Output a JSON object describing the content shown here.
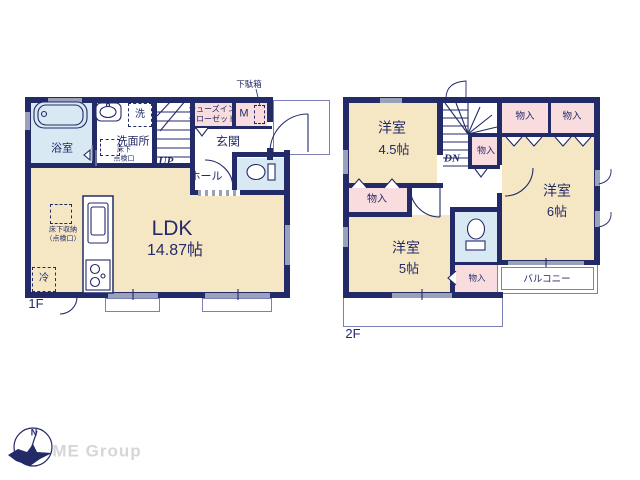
{
  "colors": {
    "wall_navy": "#232a68",
    "room_beige": "#f6e7c4",
    "closet_pink": "#f9dcdd",
    "wet_area_blue": "#d9e9f4",
    "thin_line": "#7b80b5",
    "window_gray": "#9aa2bb",
    "logo_gray": "#d6d6d6"
  },
  "floor1": {
    "label": "1F",
    "bath": "浴室",
    "washroom": "洗面所",
    "washer": "洗",
    "underfloor_inspection": "床下\n点検口",
    "shoes_in_closet": "シューズイン\nクローゼット",
    "meter_box": "M",
    "shoe_cabinet": "下駄箱",
    "entrance": "玄関",
    "hall": "ホール",
    "stairs": "UP",
    "ldk": "LDK",
    "ldk_size": "14.87帖",
    "underfloor_storage": "床下収納\n（点検口）",
    "refrigerator": "冷"
  },
  "floor2": {
    "label": "2F",
    "room_a": "洋室",
    "room_a_size": "4.5帖",
    "room_b": "洋室",
    "room_b_size": "6帖",
    "room_c": "洋室",
    "room_c_size": "5帖",
    "stairs": "DN",
    "balcony": "バルコニー",
    "closets": {
      "stair": "物入",
      "top_left": "物入",
      "top_right": "物入",
      "left": "物入",
      "bottom": "物入"
    }
  },
  "compass": {
    "north": "N"
  },
  "branding": {
    "logo": "ME Group"
  }
}
